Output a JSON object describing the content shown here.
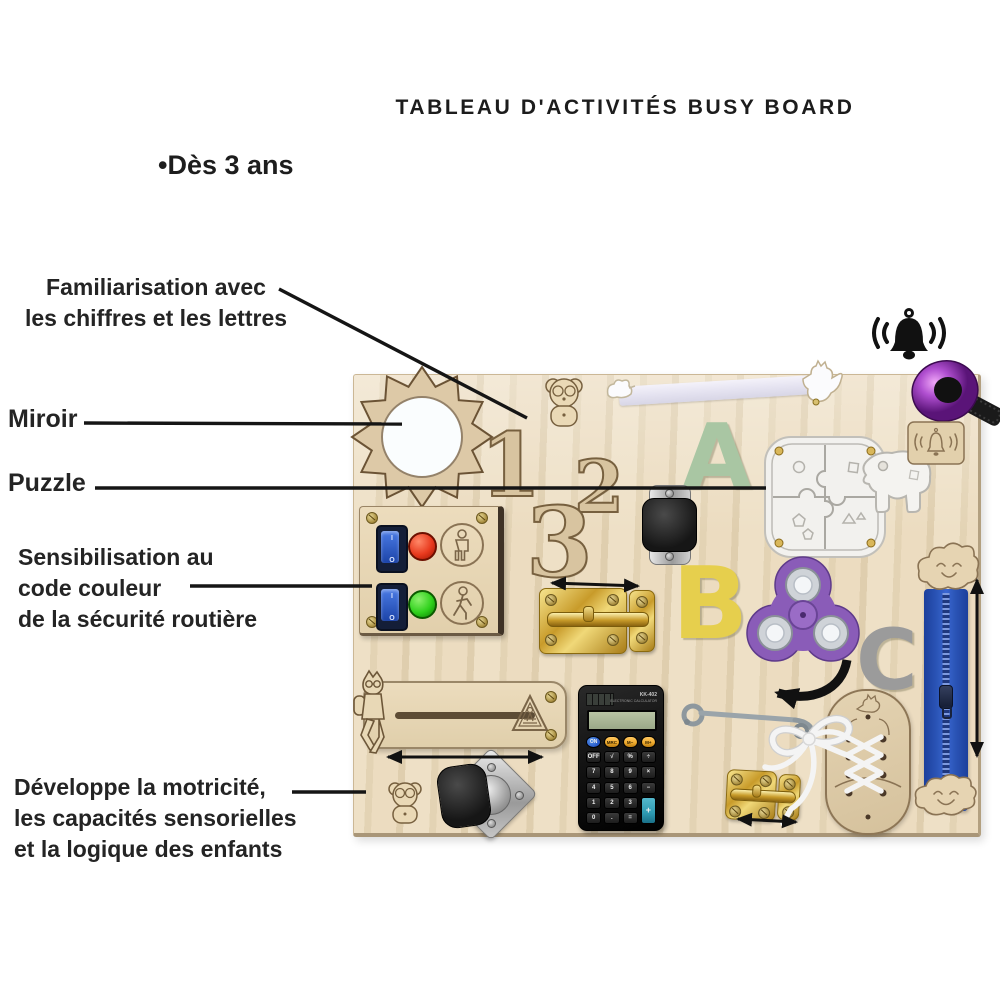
{
  "title": "TABLEAU D'ACTIVITÉS BUSY BOARD",
  "age_note": "•Dès 3 ans",
  "annotations": [
    {
      "id": "numbers-letters",
      "lines": [
        "Familiarisation avec",
        "les chiffres et les lettres"
      ]
    },
    {
      "id": "mirror",
      "lines": [
        "Miroir"
      ]
    },
    {
      "id": "puzzle",
      "lines": [
        "Puzzle"
      ]
    },
    {
      "id": "traffic-colors",
      "lines": [
        "Sensibilisation au",
        "code couleur",
        "de la sécurité routière"
      ]
    },
    {
      "id": "motor-skills",
      "lines": [
        "Développe la motricité,",
        "les capacités sensorielles",
        "et la logique des enfants"
      ]
    }
  ],
  "board": {
    "numbers": [
      "1",
      "2",
      "3"
    ],
    "letters": {
      "a": "A",
      "b": "B",
      "c": "C"
    },
    "traffic": {
      "switch_on": "I",
      "switch_off": "O"
    },
    "calculator": {
      "model": "KK-402",
      "brand_line": "ELECTRONIC CALCULATOR",
      "on_key": "ON",
      "memory_keys": [
        "MRC",
        "M−",
        "M+"
      ],
      "keys": [
        "OFF",
        "√",
        "%",
        "÷",
        "7",
        "8",
        "9",
        "×",
        "4",
        "5",
        "6",
        "−",
        "1",
        "2",
        "3",
        "0",
        ".",
        "="
      ],
      "plus_key": "+"
    },
    "items": [
      "sun-mirror",
      "wooden-numbers",
      "teddy-bear",
      "elastic-strap",
      "rooster",
      "letter-a",
      "shape-puzzle-elephant",
      "caster-wheel",
      "bicycle-bell",
      "bell-plaque",
      "cloud",
      "zipper",
      "letter-b",
      "fidget-spinner",
      "letter-c",
      "brass-barrel-latch",
      "traffic-light-switch-panel",
      "sliding-boy-track",
      "calculator",
      "hook-latch",
      "small-brass-latch",
      "lacing-shoe"
    ]
  },
  "colors": {
    "wood": "#e8dac0",
    "wood_line": "#8a7354",
    "number_wood": "#d8c4a0",
    "letter_a": "#a9c6a3",
    "letter_b": "#e6cf4d",
    "letter_c": "#9b9b9b",
    "spinner": "#8a5cb8",
    "zipper": "#2b55b7",
    "bell": "#b04fd0",
    "red_light": "#e83a1e",
    "green_light": "#2fd11c",
    "switch_blue": "#2456c8",
    "brass": "#d4a832",
    "calc_body": "#151515",
    "calc_orange": "#eda92c",
    "calc_teal": "#2e9ab2",
    "lcd": "#9aa888",
    "text": "#1d1d1d",
    "line": "#151515"
  }
}
